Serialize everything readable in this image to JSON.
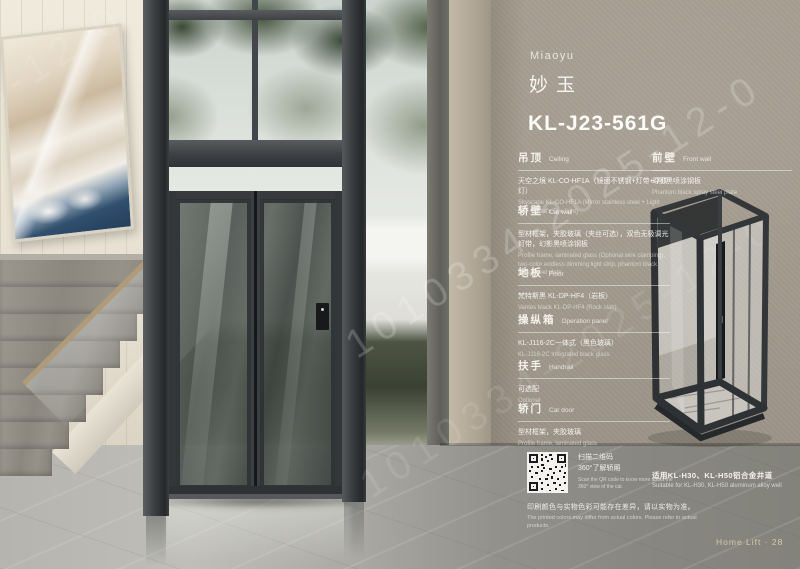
{
  "watermark": {
    "text": "1010334-2025-12-0"
  },
  "product": {
    "brand_en": "Miaoyu",
    "brand_cn": "妙玉",
    "model": "KL-J23-561G"
  },
  "specs_left": [
    {
      "title_cn": "吊顶",
      "title_en": "Ceiling",
      "desc_cn": "天空之境 KL-CO-HF1A（镜面不锈钢+灯带+平顶灯）",
      "desc_en": "Skyscape KL-CO-HF1A (Mirror stainless steel + Light belt + Roof's Eye light)"
    },
    {
      "title_cn": "轿壁",
      "title_en": "Car wall",
      "desc_cn": "型材框架，夹胶玻璃（夹丝可选），双色无极调光灯带，幻影黑喷涂钢板",
      "desc_en": "Profile frame, laminated glass (Optional wire clamping), two-color endless dimming light strip, phantom black spray steel plate"
    },
    {
      "title_cn": "地板",
      "title_en": "Floor",
      "desc_cn": "梵特斯黑 KL-DP-HF4（岩板）",
      "desc_en": "Vantes black KL-DP-HF4 (Rock slab)"
    },
    {
      "title_cn": "操纵箱",
      "title_en": "Operation panel",
      "desc_cn": "KL-J116-2C一体式（黑色玻璃）",
      "desc_en": "KL-J116-2C Integrated black glass"
    },
    {
      "title_cn": "扶手",
      "title_en": "Handrail",
      "desc_cn": "可选配",
      "desc_en": "Optional"
    },
    {
      "title_cn": "轿门",
      "title_en": "Car door",
      "desc_cn": "型材框架，夹胶玻璃",
      "desc_en": "Profile frame, laminated glass"
    }
  ],
  "specs_right": [
    {
      "title_cn": "前壁",
      "title_en": "Front wall",
      "desc_cn": "幻影黑喷涂钢板",
      "desc_en": "Phantom black spray steel plate"
    }
  ],
  "qr": {
    "caption_line1": "扫描二维码",
    "caption_line2": "360°了解轿厢",
    "note_en": "Scan the QR code to know more about the 360° view of the car."
  },
  "compatibility": {
    "cn": "适用KL-H30、KL-H50铝合金井道",
    "en": "Suitable for KL-H30, KL-H50 aluminum alloy well"
  },
  "disclaimer": {
    "cn": "印刷颜色与实物色彩可能存在差异，请以实物为准。",
    "en": "The printed colors may differ from actual colors. Please refer to actual products."
  },
  "footer": {
    "page_label": "Home Lift · 28"
  },
  "colors": {
    "panel_wall": "#a49b8f",
    "frame_dark": "#3a3e41",
    "text_light": "#f5f2ed",
    "handrail_wood": "#b29a76"
  }
}
